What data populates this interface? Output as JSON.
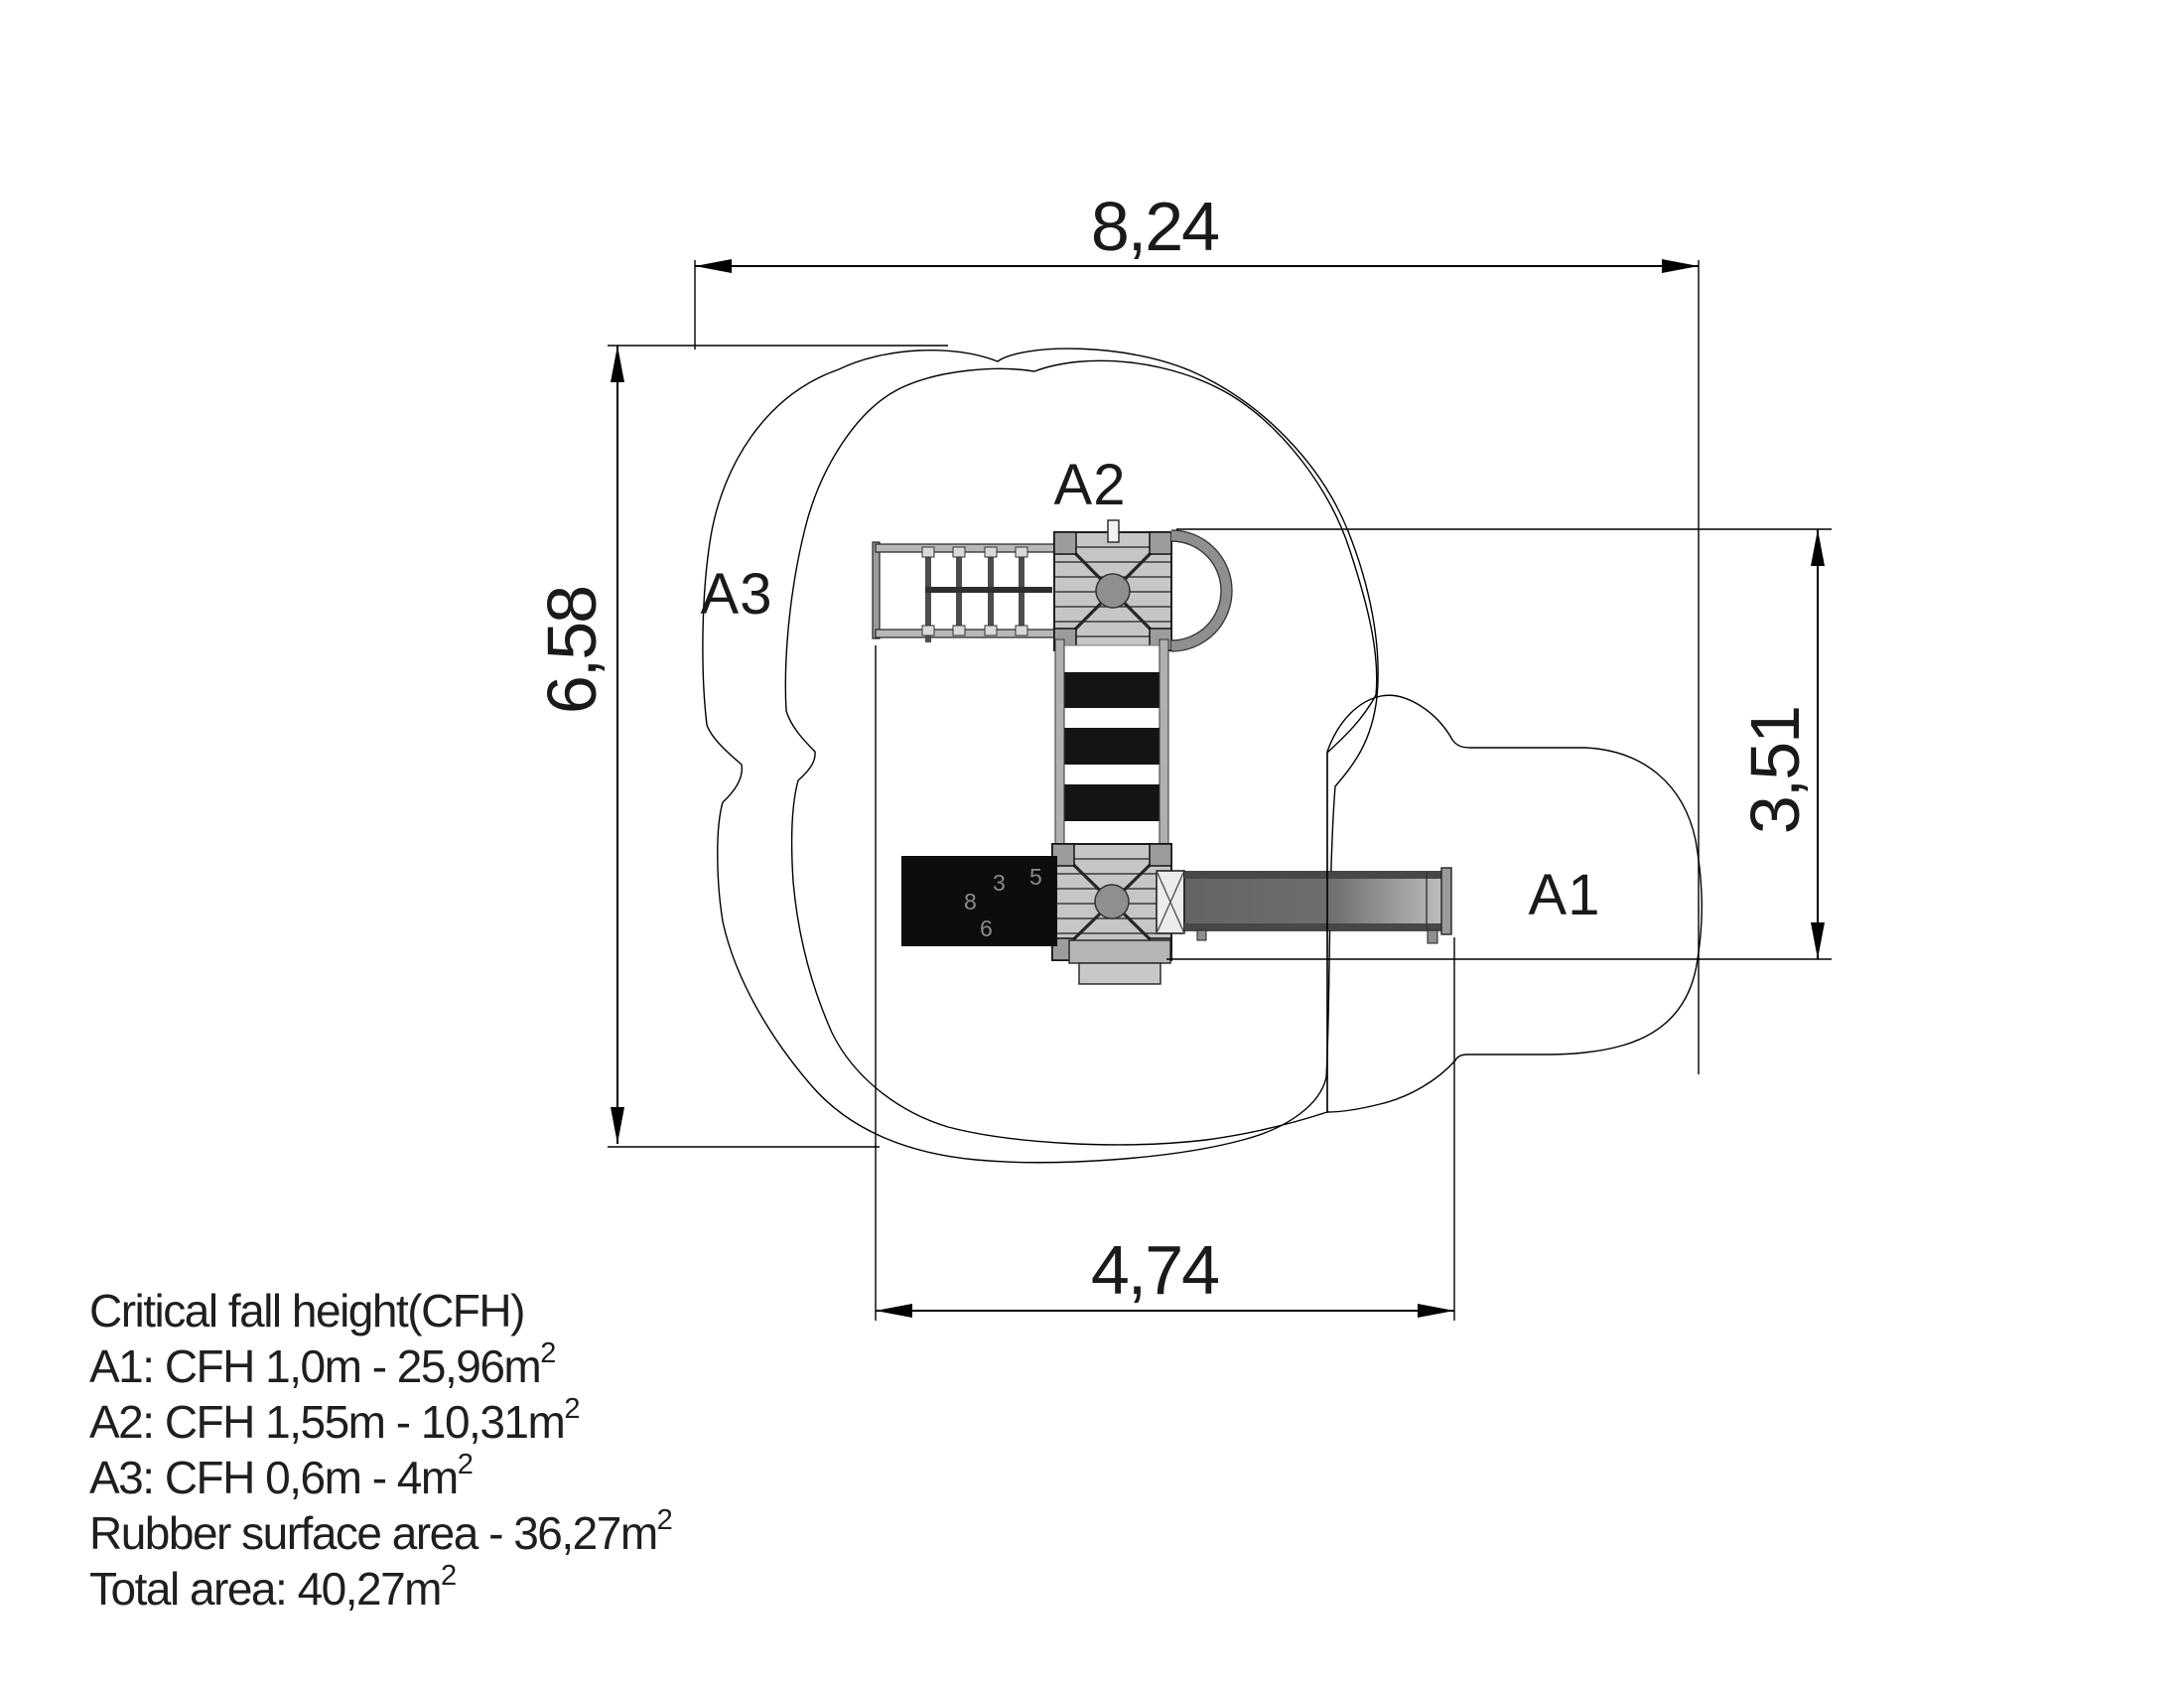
{
  "drawing": {
    "dimensions": {
      "top": "8,24",
      "left": "6,58",
      "right": "3,51",
      "bottom": "4,74"
    },
    "zone_labels": {
      "a1": "A1",
      "a2": "A2",
      "a3": "A3"
    },
    "legend": {
      "lines": [
        {
          "text": "Critical fall height(CFH)",
          "sup": ""
        },
        {
          "text": "A1: CFH 1,0m - 25,96m",
          "sup": "2"
        },
        {
          "text": "A2: CFH 1,55m - 10,31m",
          "sup": "2"
        },
        {
          "text": "A3: CFH 0,6m - 4m",
          "sup": "2"
        },
        {
          "text": "Rubber surface area - 36,27m",
          "sup": "2"
        },
        {
          "text": "Total area: 40,27m",
          "sup": "2"
        }
      ]
    },
    "panel_digits": [
      "3",
      "5",
      "8",
      "6"
    ],
    "colors": {
      "paper": "#ffffff",
      "line": "#000000",
      "platform": "#c6c6c6",
      "metal": "#b5b5b5",
      "slide_dark": "#696969",
      "slide_light": "#c3c3c3",
      "panel_black": "#0d0d0d"
    }
  }
}
